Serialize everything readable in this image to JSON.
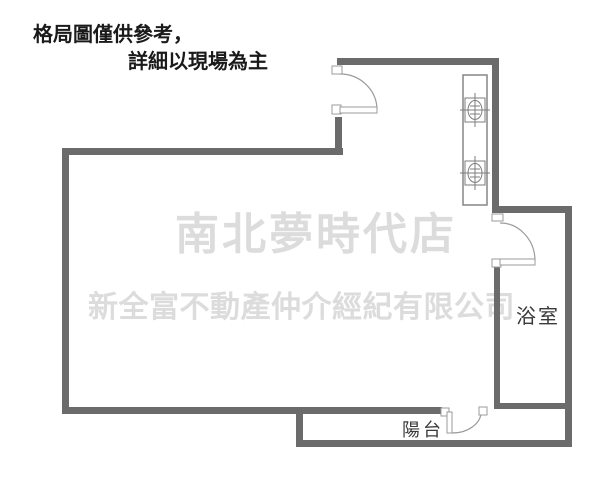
{
  "disclaimer": {
    "line1": "格局圖僅供參考，",
    "line2": "詳細以現場為主"
  },
  "watermark": {
    "store": "南北夢時代店",
    "company": "新全富不動產仲介經紀有限公司"
  },
  "labels": {
    "bathroom": "浴室",
    "balcony": "陽台"
  },
  "colors": {
    "background": "#ffffff",
    "wall": "#6b6b6b",
    "disclaimer_text": "#1a1a1a",
    "room_label": "#3a3a3a",
    "watermark": "#dcdcdc",
    "door_line": "#9b9b9b",
    "fixture_line": "#7d7d7d"
  }
}
